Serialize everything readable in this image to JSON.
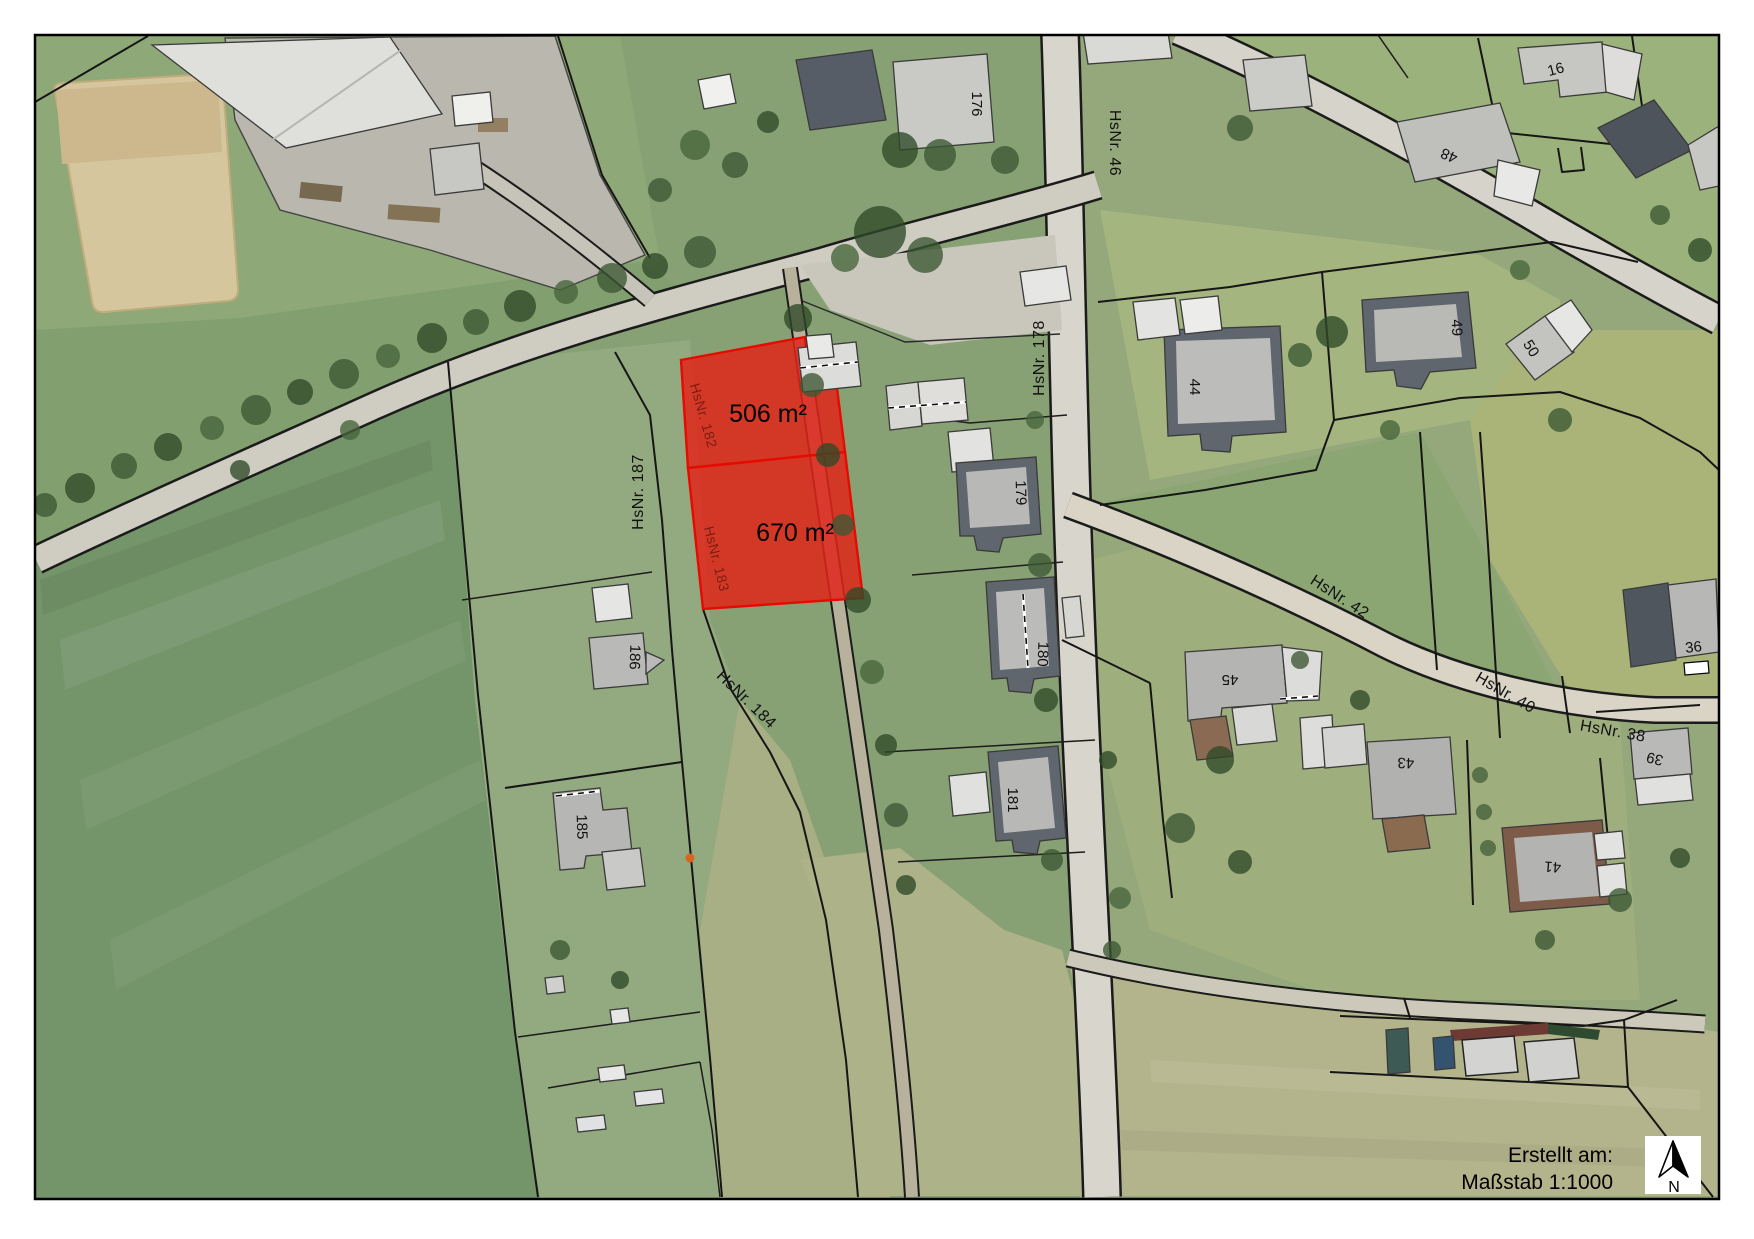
{
  "legend": {
    "created_label": "Erstellt am:",
    "scale_label": "Maßstab 1:1000",
    "north_label": "N"
  },
  "parcels": {
    "area_506": "506 m²",
    "area_670": "670 m²",
    "hsnr_182": "HsNr. 182",
    "hsnr_183": "HsNr. 183"
  },
  "streets": {
    "hsnr_46": "HsNr. 46",
    "hsnr_178": "HsNr. 178",
    "hsnr_187": "HsNr. 187",
    "hsnr_184": "HsNr. 184",
    "hsnr_42": "HsNr. 42",
    "hsnr_40": "HsNr. 40",
    "hsnr_38": "HsNr. 38"
  },
  "buildings": {
    "b176": "176",
    "b16": "16",
    "b48": "48",
    "b44": "44",
    "b49": "49",
    "b50": "50",
    "b179": "179",
    "b180": "180",
    "b181": "181",
    "b36": "36",
    "b45": "45",
    "b43": "43",
    "b41": "41",
    "b39": "39",
    "b185": "185",
    "b186": "186"
  },
  "colors": {
    "highlight_fill": "#e0261b",
    "highlight_stroke": "#e60b00",
    "label_dark_red": "#7d1d12",
    "parcel_line": "#161616"
  }
}
